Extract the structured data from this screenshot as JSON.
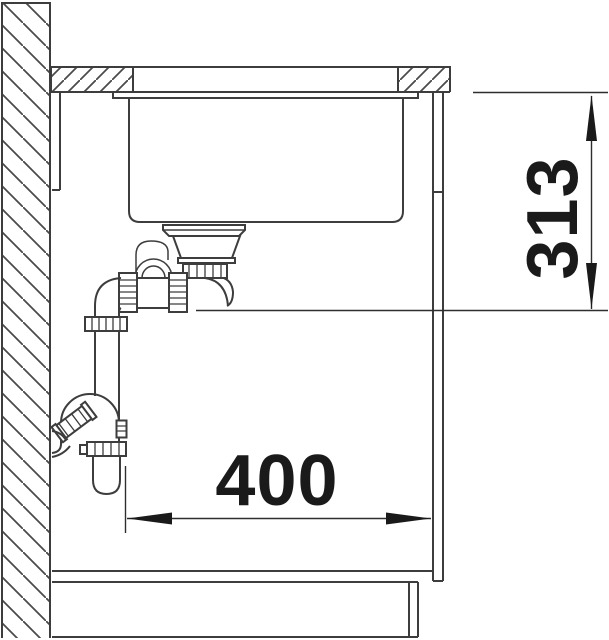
{
  "labels": {
    "height_dim": "313",
    "width_dim": "400"
  },
  "colors": {
    "background": "#ffffff",
    "drawing_line": "#3d3d3d",
    "dimension_line": "#2e2e2e",
    "dimension_text": "#1a1a1a"
  },
  "components": [
    "wall-section",
    "countertop-section",
    "undermount-sink-bowl",
    "strainer-drain",
    "space-saver-siphon-trap",
    "wall-outlet-connection",
    "cabinet-carcass",
    "plinth"
  ]
}
